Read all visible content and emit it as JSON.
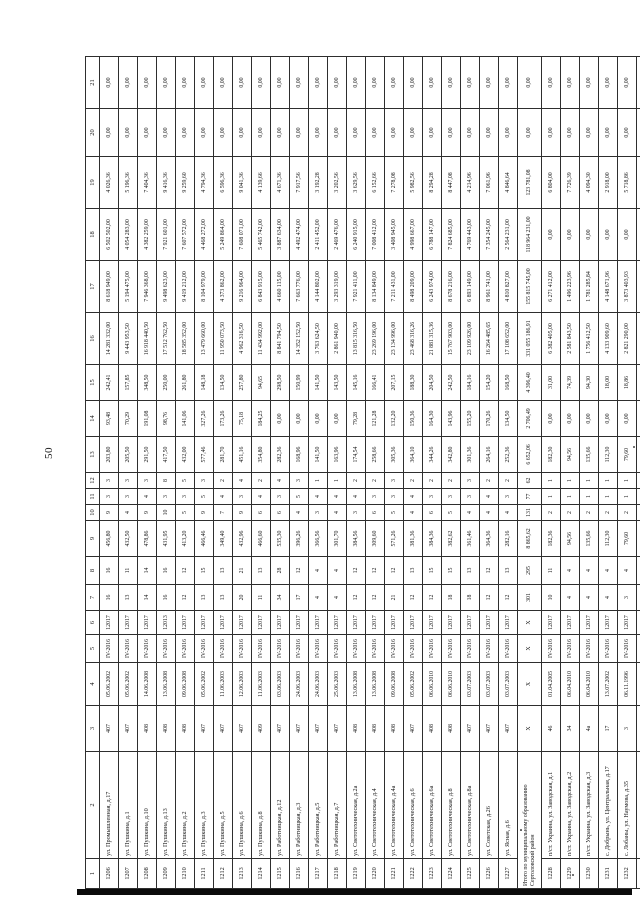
{
  "page": {
    "number": "50"
  },
  "table": {
    "columns": [
      "1",
      "2",
      "3",
      "4",
      "5",
      "6",
      "7",
      "8",
      "9",
      "10",
      "11",
      "12",
      "13",
      "14",
      "15",
      "16",
      "17",
      "18",
      "19",
      "20",
      "21"
    ],
    "rows": [
      [
        "1206",
        "ул. Промышленная, д.17",
        "407",
        "05.06.2002",
        "IV-2016",
        "12017",
        "16",
        "16",
        "456,80",
        "9",
        "3",
        "3",
        "203,80",
        "93,48",
        "242,41",
        "14 281 332,00",
        "8 618 949,00",
        "6 502 502,00",
        "4 026,36",
        "0,00",
        "0,00"
      ],
      [
        "1207",
        "ул. Пушкина, д.1",
        "407",
        "05.06.2002",
        "IV-2016",
        "12017",
        "13",
        "11",
        "432,50",
        "4",
        "3",
        "3",
        "205,50",
        "70,29",
        "157,85",
        "9 443 953,50",
        "5 194 475,00",
        "4 054 283,00",
        "5 196,36",
        "0,00",
        "0,00"
      ],
      [
        "1208",
        "ул. Пушкина, д.10",
        "408",
        "14.06.2008",
        "IV-2016",
        "12017",
        "14",
        "14",
        "478,86",
        "9",
        "4",
        "3",
        "291,50",
        "191,08",
        "348,50",
        "16 918 440,50",
        "7 946 368,00",
        "4 382 259,00",
        "7 404,36",
        "0,00",
        "0,00"
      ],
      [
        "1209",
        "ул. Пушкина, д.13",
        "408",
        "13.06.2008",
        "IV-2016",
        "12013",
        "16",
        "16",
        "431,95",
        "10",
        "3",
        "8",
        "417,50",
        "98,76",
        "250,00",
        "17 512 762,50",
        "9 498 623,00",
        "7 921 601,00",
        "9 416,36",
        "0,00",
        "0,00"
      ],
      [
        "1210",
        "ул. Пушкина, д.2",
        "408",
        "09.06.2008",
        "IV-2016",
        "12017",
        "12",
        "12",
        "413,20",
        "5",
        "3",
        "5",
        "432,00",
        "141,06",
        "261,80",
        "18 585 352,00",
        "9 419 212,00",
        "7 607 572,00",
        "9 259,60",
        "0,00",
        "0,00"
      ],
      [
        "1211",
        "ул. Пушкина, д.3",
        "407",
        "05.06.2002",
        "IV-2016",
        "12017",
        "13",
        "15",
        "466,46",
        "9",
        "5",
        "3",
        "577,46",
        "327,26",
        "148,18",
        "13 479 660,00",
        "8 104 979,00",
        "4 468 272,00",
        "4 794,36",
        "0,00",
        "0,00"
      ],
      [
        "1212",
        "ул. Пушкина, д.5",
        "407",
        "11.06.2003",
        "IV-2016",
        "12017",
        "13",
        "13",
        "349,40",
        "7",
        "4",
        "2",
        "281,70",
        "173,26",
        "134,50",
        "11 950 073,50",
        "4 373 862,00",
        "5 249 864,00",
        "6 596,36",
        "0,00",
        "0,00"
      ],
      [
        "1213",
        "ул. Пушкина, д.6",
        "407",
        "12.06.2003",
        "IV-2016",
        "12017",
        "20",
        "21",
        "432,96",
        "9",
        "3",
        "4",
        "451,16",
        "75,18",
        "257,80",
        "4 962 316,50",
        "9 216 964,00",
        "7 608 071,00",
        "9 041,36",
        "0,00",
        "0,00"
      ],
      [
        "1214",
        "ул. Пушкина, д.8",
        "409",
        "11.06.2003",
        "IV-2016",
        "12017",
        "11",
        "13",
        "466,60",
        "6",
        "4",
        "2",
        "354,80",
        "184,25",
        "94,65",
        "11 434 992,00",
        "6 843 915,00",
        "5 465 742,00",
        "4 139,66",
        "0,00",
        "0,00"
      ],
      [
        "1215",
        "ул. Работницкая, д.12",
        "407",
        "03.06.2003",
        "IV-2016",
        "12017",
        "34",
        "28",
        "535,30",
        "6",
        "3",
        "4",
        "282,36",
        "0,00",
        "298,50",
        "8 841 794,50",
        "4 660 115,00",
        "3 887 634,00",
        "4 671,36",
        "0,00",
        "0,00"
      ],
      [
        "1216",
        "ул. Работницкая, д.3",
        "407",
        "24.06.2003",
        "IV-2016",
        "12017",
        "17",
        "12",
        "396,26",
        "4",
        "5",
        "3",
        "168,96",
        "0,00",
        "150,99",
        "14 352 152,50",
        "7 663 776,00",
        "4 492 474,00",
        "7 917,56",
        "0,00",
        "0,00"
      ],
      [
        "1217",
        "ул. Работницкая, д.5",
        "407",
        "24.06.2003",
        "IV-2016",
        "12017",
        "4",
        "4",
        "366,56",
        "3",
        "4",
        "1",
        "141,50",
        "0,00",
        "141,50",
        "3 763 624,50",
        "4 144 802,00",
        "2 411 452,00",
        "3 192,28",
        "0,00",
        "0,00"
      ],
      [
        "1218",
        "ул. Работницкая, д.7",
        "407",
        "25.06.2003",
        "IV-2016",
        "12017",
        "4",
        "4",
        "301,70",
        "4",
        "4",
        "1",
        "163,96",
        "0,00",
        "143,50",
        "2 861 940,00",
        "3 293 319,00",
        "2 469 476,00",
        "3 202,56",
        "0,00",
        "0,00"
      ],
      [
        "1219",
        "ул. Светотехническая, д.2а",
        "408",
        "13.06.2008",
        "IV-2016",
        "12017",
        "12",
        "12",
        "384,56",
        "3",
        "4",
        "2",
        "174,54",
        "79,28",
        "145,16",
        "13 815 316,50",
        "7 921 411,00",
        "6 240 915,00",
        "3 629,56",
        "0,00",
        "0,00"
      ],
      [
        "1220",
        "ул. Светотехническая, д.4",
        "408",
        "13.06.2008",
        "IV-2016",
        "12017",
        "12",
        "12",
        "309,60",
        "6",
        "3",
        "2",
        "258,66",
        "121,28",
        "166,41",
        "23 269 196,00",
        "8 134 849,00",
        "7 008 412,00",
        "6 152,66",
        "0,00",
        "0,00"
      ],
      [
        "1221",
        "ул. Светотехническая, д.4а",
        "408",
        "09.06.2008",
        "IV-2016",
        "12017",
        "21",
        "12",
        "571,26",
        "5",
        "3",
        "3",
        "305,36",
        "132,20",
        "207,15",
        "23 134 996,00",
        "7 211 431,00",
        "3 408 945,00",
        "7 278,08",
        "0,00",
        "0,00"
      ],
      [
        "1222",
        "ул. Светотехническая, д.6",
        "407",
        "05.06.2002",
        "IV-2016",
        "12017",
        "12",
        "13",
        "381,36",
        "4",
        "4",
        "2",
        "364,10",
        "150,36",
        "188,30",
        "23 468 316,26",
        "8 498 209,00",
        "4 998 667,00",
        "5 982,56",
        "0,00",
        "0,00"
      ],
      [
        "1223",
        "ул. Светотехническая, д.6а",
        "408",
        "06.06.2010",
        "IV-2016",
        "12017",
        "12",
        "15",
        "384,36",
        "6",
        "3",
        "2",
        "344,26",
        "164,30",
        "204,50",
        "21 881 315,36",
        "6 243 974,00",
        "6 788 147,00",
        "8 294,28",
        "0,00",
        "0,00"
      ],
      [
        "1224",
        "ул. Светотехническая, д.8",
        "408",
        "06.06.2010",
        "IV-2016",
        "12017",
        "18",
        "15",
        "382,62",
        "5",
        "3",
        "2",
        "342,80",
        "143,96",
        "242,50",
        "15 767 903,00",
        "8 678 216,00",
        "7 824 685,00",
        "8 447,08",
        "0,00",
        "0,00"
      ],
      [
        "1225",
        "ул. Светотехническая, д.8а",
        "407",
        "03.07.2003",
        "IV-2016",
        "12017",
        "18",
        "13",
        "361,46",
        "4",
        "3",
        "3",
        "301,36",
        "155,20",
        "184,16",
        "23 109 926,00",
        "6 893 149,00",
        "4 769 443,00",
        "4 214,96",
        "0,00",
        "0,00"
      ],
      [
        "1226",
        "ул. Советская, д.26",
        "407",
        "03.07.2003",
        "IV-2016",
        "12017",
        "12",
        "12",
        "364,36",
        "4",
        "4",
        "2",
        "264,16",
        "170,26",
        "154,20",
        "16 264 485,65",
        "8 961 741,00",
        "7 354 245,00",
        "7 061,96",
        "0,00",
        "0,00"
      ],
      [
        "1227",
        "ул. Ясная, д.6",
        "407",
        "03.07.2003",
        "IV-2016",
        "12017",
        "12",
        "13",
        "282,16",
        "4",
        "3",
        "2",
        "252,36",
        "134,50",
        "168,50",
        "17 108 652,00",
        "4 810 827,00",
        "2 564 231,00",
        "4 846,64",
        "0,00",
        "0,00"
      ],
      {
        "type": "total",
        "label": "Итого по муниципальному образованию Сертоловский район",
        "values": [
          "X",
          "X",
          "X",
          "X",
          "301",
          "295",
          "8 865,62",
          "131",
          "77",
          "62",
          "6 652,06",
          "2 706,49",
          "4 396,40",
          "331 055 186,91",
          "155 815 745,00",
          "118 964 231,00",
          "123 781,08",
          "0,00",
          "0,00"
        ]
      },
      [
        "1228",
        "п/ст. Украина, ул. Заводская, д.1",
        "46",
        "01.04.2005",
        "IV-2016",
        "12017",
        "10",
        "11",
        "182,36",
        "2",
        "1",
        "1",
        "182,30",
        "0,00",
        "31,00",
        "6 382 405,00",
        "6 271 412,00",
        "0,00",
        "6 804,00",
        "0,00",
        "0,00"
      ],
      [
        "1229",
        "п/ст. Украина, ул. Заводская, д.2",
        "34",
        "06.04.2010",
        "IV-2016",
        "12017",
        "4",
        "4",
        "94,56",
        "2",
        "1",
        "1",
        "94,56",
        "0,00",
        "74,39",
        "2 581 843,50",
        "1 496 223,96",
        "0,00",
        "7 726,39",
        "0,00",
        "0,00"
      ],
      [
        "1230",
        "п/ст. Украина, ул. Заводская, д.3",
        "4а",
        "06.04.2010",
        "IV-2016",
        "12017",
        "4",
        "4",
        "135,66",
        "2",
        "1",
        "1",
        "135,66",
        "0,00",
        "94,30",
        "1 756 412,50",
        "1 781 285,84",
        "0,00",
        "4 094,30",
        "0,00",
        "0,00"
      ],
      [
        "1231",
        "с. Добрынь, ул. Центральная, д.17",
        "17",
        "13.07.2002",
        "IV-2016",
        "12017",
        "4",
        "4",
        "112,30",
        "2",
        "1",
        "1",
        "112,30",
        "0,00",
        "18,00",
        "4 133 909,60",
        "4 148 671,96",
        "0,00",
        "2 918,00",
        "0,00",
        "0,00"
      ],
      [
        "1232",
        "с. Лобаны, ул. Наумова, д.35",
        "3",
        "06.11.1996",
        "IV-2016",
        "12017",
        "3",
        "4",
        "79,60",
        "2",
        "1",
        "1",
        "79,60",
        "0,00",
        "18,86",
        "2 821 290,00",
        "3 873 403,93",
        "0,00",
        "5 718,86",
        "0,00",
        "0,00"
      ],
      [
        "1233",
        "с. Поляна, ул. Нёман, д.15",
        "4б",
        "26.07.2007",
        "IV-2016",
        "12017",
        "3",
        "4",
        "79,60",
        "2",
        "1",
        "1",
        "79,60",
        "0,00",
        "17,86",
        "2 580 590,60",
        "2 582 287,00",
        "0,00",
        "2 417,86",
        "0,00",
        "0,00"
      ]
    ]
  }
}
